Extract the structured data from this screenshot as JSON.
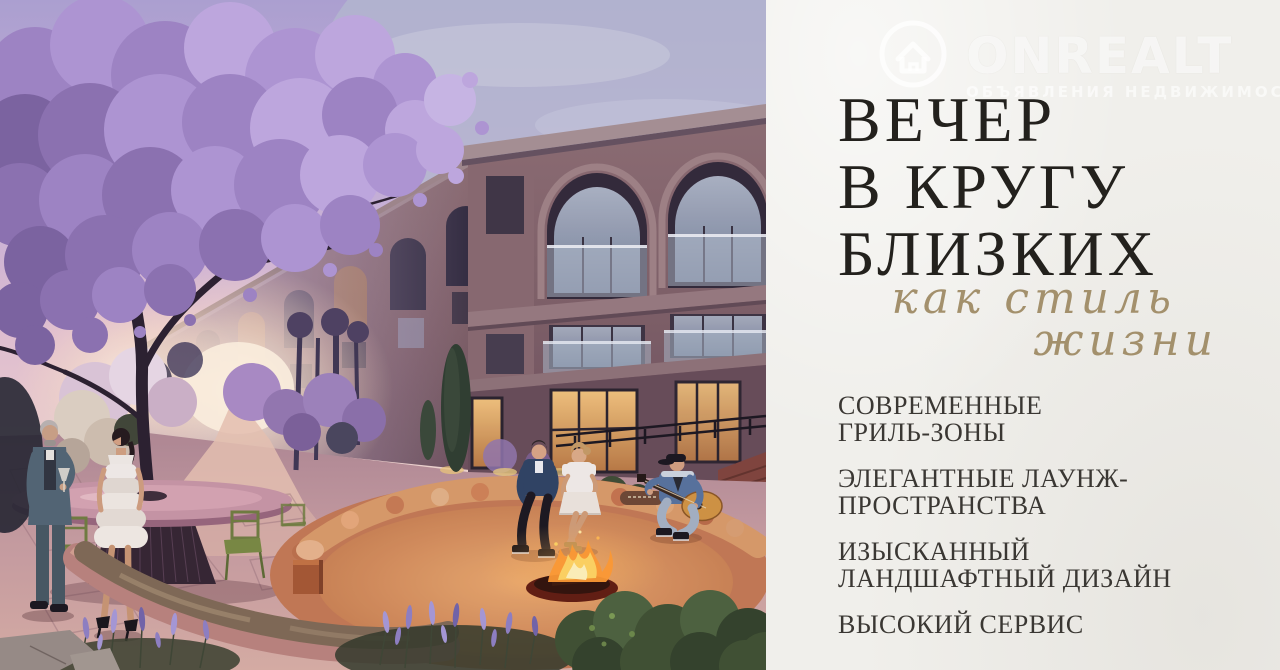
{
  "meta": {
    "language": "ru",
    "kind": "real-estate-promo-banner"
  },
  "watermark": {
    "brand": "ONREALT",
    "tagline": "ОБЪЯВЛЕНИЯ НЕДВИЖИМОСТИ",
    "icon": "house-in-circle"
  },
  "panel": {
    "background_color": "#f0efeb",
    "heading": {
      "lines": [
        "ВЕЧЕР",
        "В КРУГУ",
        "БЛИЗКИХ"
      ],
      "color": "#23211d"
    },
    "script": {
      "lines": [
        "как стиль",
        "жизни"
      ],
      "color": "#a3906c"
    },
    "features": [
      {
        "lines": [
          "СОВРЕМЕННЫЕ",
          "ГРИЛЬ-ЗОНЫ"
        ]
      },
      {
        "lines": [
          "ЭЛЕГАНТНЫЕ ЛАУНЖ-",
          "ПРОСТРАНСТВА"
        ]
      },
      {
        "lines": [
          "ИЗЫСКАННЫЙ",
          "ЛАНДШАФТНЫЙ ДИЗАЙН"
        ]
      },
      {
        "lines": [
          "ВЫСОКИЙ СЕРВИС"
        ]
      }
    ],
    "text_color": "#3a3733"
  },
  "photo": {
    "alt": "Вечерний двор жилого комплекса: цветущее сиреневое дерево, трёхэтажный дом с арками и террасами, круглая лаунж-зона с костром, гости с бокалами и гитарой, лавандовый сад",
    "accent_colors": {
      "sky_lavender": "#b2a8d4",
      "blossom": "#9d84c4",
      "facade": "#7b5d64",
      "terracotta_lounge": "#c27851",
      "fire": "#ff9a2e",
      "lavender_plants": "#8d7fc2",
      "sunset_glow": "#fff4e0"
    }
  }
}
